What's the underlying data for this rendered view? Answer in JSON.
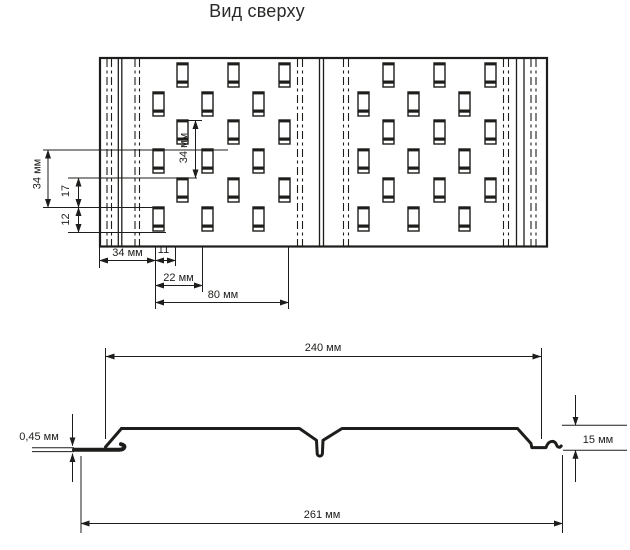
{
  "title": "Вид сверху",
  "colors": {
    "ink": "#1d1d1b",
    "background": "#ffffff"
  },
  "top_view": {
    "dim_labels": {
      "row_pitch_left": "34 мм",
      "row_offset": "17",
      "slot_height": "12",
      "row_pitch_inner": "34 мм",
      "edge_to_slot": "34 мм",
      "slot_width": "11",
      "column_offset": "22 мм",
      "pattern_pitch": "80 мм"
    }
  },
  "profile_view": {
    "dim_labels": {
      "working_width": "240 мм",
      "overall_width": "261 мм",
      "metal_thickness": "0,45 мм",
      "profile_height": "15 мм"
    }
  }
}
